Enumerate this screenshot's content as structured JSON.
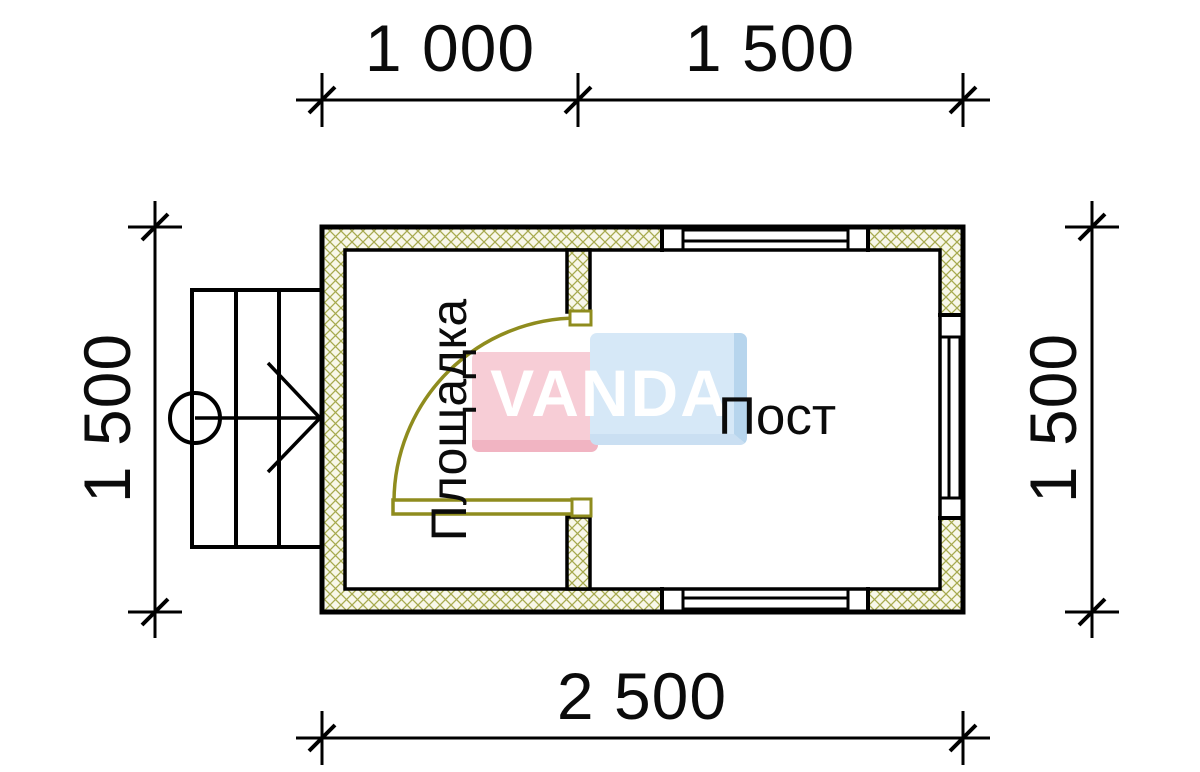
{
  "plan": {
    "watermark": {
      "text": "VANDA",
      "pink_color": "#f7cdd6",
      "blue_color": "#d6e8f7",
      "text_color": "#ffffff"
    },
    "dimensions": {
      "top_left": "1 000",
      "top_right": "1 500",
      "bottom": "2 500",
      "left": "1 500",
      "right": "1 500"
    },
    "rooms": {
      "left": "Площадка",
      "right": "Пост"
    },
    "colors": {
      "line": "#000000",
      "door": "#8f8c1e",
      "wall_hatch_line": "#a6a94e",
      "wall_hatch_bg": "#f8f7e9"
    }
  }
}
